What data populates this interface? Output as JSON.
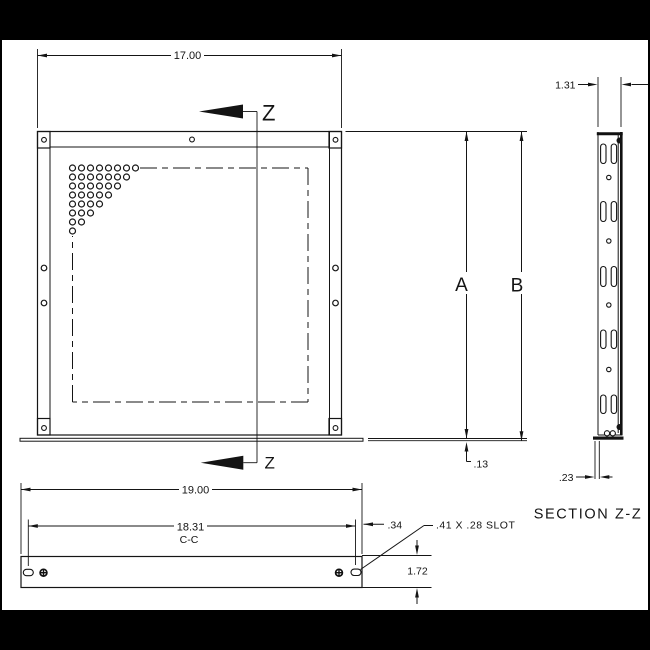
{
  "colors": {
    "background": "#000000",
    "paper": "#ffffff",
    "line": "#141414"
  },
  "front_view": {
    "width_dim": "17.00",
    "height_dim_a": "A",
    "height_dim_b": "B",
    "flange_offset_dim": ".13",
    "cut_label": "Z"
  },
  "bottom_view": {
    "width_dim": "19.00",
    "cc_dim": "18.31",
    "cc_label": "C-C",
    "edge_dim": ".34",
    "slot_note": ".41 X .28 SLOT",
    "height_dim": "1.72"
  },
  "section_view": {
    "width_dim": "1.31",
    "flange_dim": ".23",
    "title": "SECTION Z-Z"
  },
  "geometry": {
    "vent_hole_rows": [
      8,
      7,
      6,
      5,
      4,
      3,
      2,
      1
    ],
    "section_slot_rows": 5
  }
}
